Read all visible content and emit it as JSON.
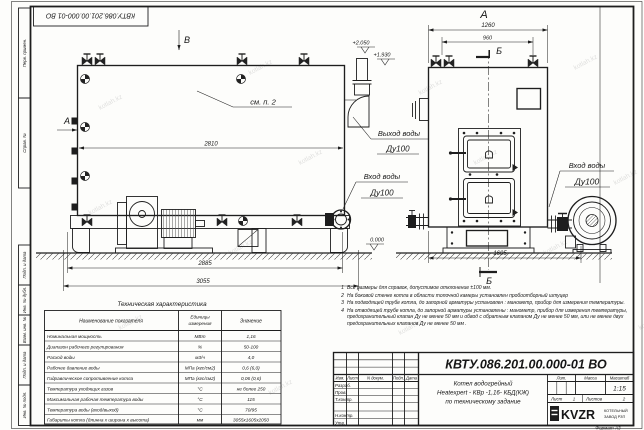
{
  "watermark": {
    "text": "kotlah.kz"
  },
  "stamp_top": {
    "doc_number": "КВТУ.086.201.00.000-01  ВО"
  },
  "margin_labels": {
    "perv": "Перв. примен.",
    "sprav": "Справ. №",
    "podp1": "Подп. и дата",
    "inv_dubl": "Инв. № дубл.",
    "vzam": "Взам. инв. №",
    "podp2": "Подп. и дата",
    "inv_podl": "Инв. № подл."
  },
  "side_view": {
    "view_label_a": "А",
    "view_label_b": "В",
    "see_note": "см. п. 2",
    "level_top": "+2.050",
    "level_mid": "+1.930",
    "level_zero": "0.000",
    "dim_inner": "2810",
    "dim_mid": "2885",
    "dim_total": "3055",
    "outlet_line1": "Выход воды",
    "outlet_line2": "Ду100",
    "inlet_line1": "Вход воды",
    "inlet_line2": "Ду100"
  },
  "front_view": {
    "view_label": "А",
    "section_label_top": "Б",
    "section_label_bottom": "Б",
    "dim_width_total": "1260",
    "dim_width_inner": "960",
    "dim_depth": "1605",
    "inlet_line1": "Вход воды",
    "inlet_line2": "Ду100"
  },
  "spec_table": {
    "title": "Техническая характеристика",
    "headers": {
      "name": "Наименование показателя",
      "unit1": "Единицы",
      "unit2": "измерения",
      "value": "Значение"
    },
    "rows": [
      {
        "name": "Номинальная мощность",
        "unit": "МВт",
        "value": "1,16"
      },
      {
        "name": "Диапазон рабочего регулирования",
        "unit": "%",
        "value": "50-100"
      },
      {
        "name": "Расход воды",
        "unit": "м3/ч",
        "value": "4,0"
      },
      {
        "name": "Рабочее давление воды",
        "unit": "МПа (кгс/см2)",
        "value": "0,6 (6,0)"
      },
      {
        "name": "Гидравлическое сопротивление котла",
        "unit": "МПа (кгс/см2)",
        "value": "0,06 (0,6)"
      },
      {
        "name": "Температура уходящих газов",
        "unit": "°С",
        "value": "не более 250"
      },
      {
        "name": "Максимальная рабочая температура воды",
        "unit": "°С",
        "value": "115"
      },
      {
        "name": "Температура воды (вход/выход)",
        "unit": "°С",
        "value": "70/95"
      },
      {
        "name": "Габариты котла (длинна х ширина х высота)",
        "unit": "мм",
        "value": "3055х1605х2050"
      }
    ]
  },
  "notes": [
    {
      "num": "1",
      "text": "Все размеры для справок, допустимое отклонение  ±100 мм."
    },
    {
      "num": "2",
      "text": "На боковой стенке котла в области топочной камеры установлен пробоотборный штуцер"
    },
    {
      "num": "3",
      "text": "На  подводящей трубе котла, до запорной арматуры установлен : манометр, прибор для измерения температуры."
    },
    {
      "num": "4",
      "text": "На отводящей трубе котла, до запорной арматуры установлены : манометр, прибор для измерения температуры, предохранительный клапан  Ду не менее  50 мм и обвод с обратным клапаном  Ду не менее  50 мм, или не менее двух предохранительных клапанов  Ду не менее 50 мм ."
    }
  ],
  "title_block": {
    "doc_number": "КВТУ.086.201.00.000-01  ВО",
    "name_line1": "Котел водогрейный",
    "name_line2": "Heatexpert - КВр -1,16- КБД(КЖ)",
    "name_line3": "по техническому задание",
    "col_izm": "Изм.",
    "col_list": "Лист",
    "col_doc": "N докум.",
    "col_podp": "Подп.",
    "col_data": "Дата",
    "row_razrab": "Разраб.",
    "row_prov": "Пров.",
    "row_tkontr": "Т.контр.",
    "row_nkontr": "Н.контр.",
    "row_utv": "Утв.",
    "lit_label": "Лит.",
    "massa_label": "Масса",
    "masshtab_label": "Масштаб",
    "scale_value": "1:15",
    "sheet_label": "Лист",
    "sheet_value": "1",
    "sheets_label": "Листов",
    "sheets_value": "2",
    "logo_text": "KVZR",
    "logo_sub1": "КОТЕЛЬНЫЙ",
    "logo_sub2": "ЗАВОД РЗП",
    "format_label": "Формат  А3"
  }
}
